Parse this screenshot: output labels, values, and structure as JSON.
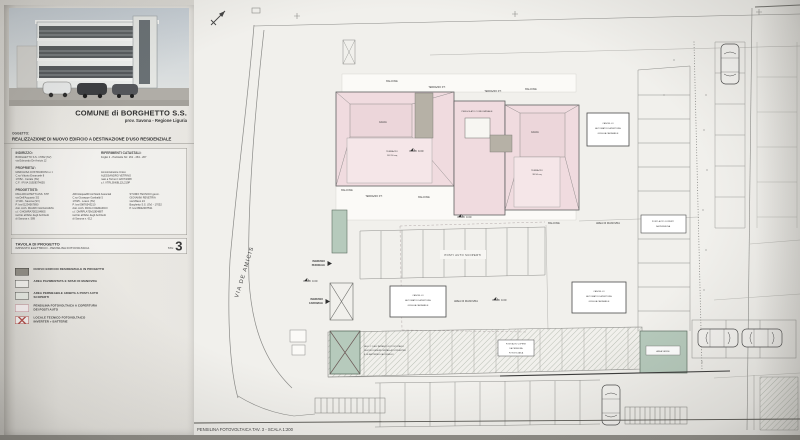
{
  "title_block": {
    "commune": "COMUNE di BORGHETTO S.S.",
    "province": "prov. Savona - Regione Liguria",
    "oggetto_label": "OGGETTO:",
    "oggetto": "REALIZZAZIONE DI NUOVO EDIFICIO A DESTINAZIONE D'USO RESIDENZIALE",
    "indirizzo_label": "INDIRIZZO:",
    "indirizzo_lines": [
      "BORGHETTO S.S. 17052 (SV)",
      "via Edmondo De Amicis 12"
    ],
    "catasto_label": "RIFERIMENTI CATASTALI:",
    "catasto_lines": [
      "Foglio 2 - Particelle Nrr. 261 - 263 - 267"
    ],
    "proprieta_label": "PROPRIETA':",
    "proprieta_col1": [
      "MARCHISA COSTRUZIONI s.r.l.",
      "C.so Vittorio Emanuele 8",
      "17052 - Ceriale (SV)",
      "C.F. / P.IVA 01928374655"
    ],
    "proprieta_col2": [
      "Amministratore Unico",
      "ALESSANDRO VETRINO",
      "nato a Torino il 12/07/1968",
      "c.f. VTRLSN68L12L219P"
    ],
    "progettisti_label": "PROGETTISTI:",
    "progettisti_col1": [
      "DNA ARCHITETTI ASS. STP",
      "via Dell'Acquario 3/2",
      "17100 - Savona (SV)",
      "P. Iva 01234567890",
      "dott. Arch. MAURO GHIGLIAZZA",
      "c.f. GHGMRA70E15I480S",
      "iscritto all'Albo degli Architetti",
      "di Savona n. 589"
    ],
    "progettisti_col2": [
      "ARCHsquadID Architetti Associati",
      "C.so Giuseppe Garibaldi 5",
      "17025 - Loano (SV)",
      "P. Iva 09876543210",
      "dott. Arch. PAOLO DEMARCO",
      "c.f. DMRPLA75M10E488T",
      "iscritto all'Albo degli Architetti",
      "di Savona n. 612"
    ],
    "progettisti_col3": [
      "STUDIO TECNICO geom.",
      "GIOVANNI REVETRIA",
      "via Milano 24",
      "Borghetto S.S. (SV) - 17052",
      "P. Iva 08642097531"
    ],
    "tavola_label": "TAVOLA DI PROGETTO",
    "tavola_subtitle": "IMPIANTO ELETTRICO - PENSILINA FOTOVOLTAICA",
    "tav_label": "TAV.",
    "tav_number": "3"
  },
  "legend": {
    "items": [
      {
        "type": "building",
        "lines": [
          "NUOVO EDIFICIO RESIDENZIALE IN PROGETTO"
        ]
      },
      {
        "type": "paved",
        "lines": [
          "AREA PAVIMENTATA E SPAZI DI MANOVRA"
        ]
      },
      {
        "type": "permeable",
        "lines": [
          "AREA PERMEABILE ADIBITA A POSTI AUTO",
          "SCOPERTI"
        ]
      },
      {
        "type": "pensilina",
        "lines": [
          "PENSILINA FOTOVOLTAICA A COPERTURA",
          "DEI POSTI AUTO"
        ]
      },
      {
        "type": "locale",
        "lines": [
          "LOCALE TECNICO FOTOVOLTAICO",
          "INVERTER + BATTERIE"
        ]
      }
    ]
  },
  "plan": {
    "street_name": "VIA DE AMICIS",
    "scale_note": "PENSILINA FOTOVOLTAICA TAV. 3 - SCALA 1:200",
    "labels": {
      "balcone": "BALCONE",
      "terrazzo_pt": "TERRAZZO P.T.",
      "falda": "FALDA",
      "pergolato": "PERGOLATO CONDOMINIALE",
      "terrazzo": "TERRAZZO",
      "terrazzo_mq_1": "102.50 mq",
      "terrazzo_mq_2": "98.50 mq",
      "posti_auto_scoperti": "POSTI AUTO SCOPERTI",
      "area_manovra": "AREA DI MANOVRA",
      "area_verde": "AREA VERDE"
    },
    "ingresso_pedonale": [
      "INGRESSO",
      "PEDONALE"
    ],
    "ingresso_carrabile": [
      "INGRESSO",
      "CARRABILE"
    ],
    "cancello_box": [
      "CANCELLO",
      "AUTOMATICO APERTURA",
      "GRIGLIA CARRABILE"
    ],
    "posti_coperti_box": [
      "POSTI AUTO COPERTI",
      "DA PENSILINA"
    ],
    "pensilina_band_label": [
      "POSTI AUTO COPERTI",
      "DA PENSILINA",
      "FOTOVOLTAICA"
    ],
    "locale_note": [
      "NEL L.T. DELL'IMPIANTO FOTOVOLTAICO",
      "DEVONO ESSERE INSTALLATI L'INVERTER",
      "E LE BATTERIE DI ACCUMULO"
    ],
    "levels": {
      "roof": "9.00",
      "piano_terra": "0.00",
      "ingresso": "0.00",
      "manovra": "0.00"
    }
  }
}
